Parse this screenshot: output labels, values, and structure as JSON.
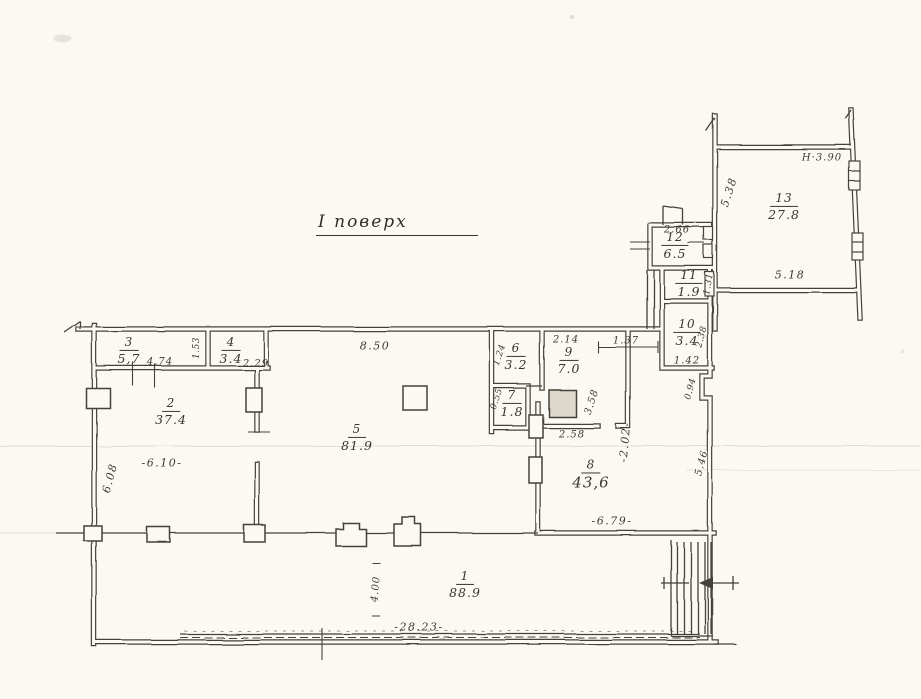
{
  "title": "І поверх",
  "rooms": [
    {
      "number": "1",
      "area": "88.9"
    },
    {
      "number": "2",
      "area": "37.4"
    },
    {
      "number": "3",
      "area": "5,7"
    },
    {
      "number": "4",
      "area": "3.4"
    },
    {
      "number": "5",
      "area": "81.9"
    },
    {
      "number": "6",
      "area": "3.2"
    },
    {
      "number": "7",
      "area": "1.8"
    },
    {
      "number": "8",
      "area": "43,6"
    },
    {
      "number": "9",
      "area": "7.0"
    },
    {
      "number": "10",
      "area": "3.4"
    },
    {
      "number": "11",
      "area": "1.9"
    },
    {
      "number": "12",
      "area": "6.5"
    },
    {
      "number": "13",
      "area": "27.8"
    }
  ],
  "dims": {
    "top_span": "8.50",
    "room2_width": "-6.10-",
    "room2_height": "6.08",
    "room3_width": "4.74",
    "room3_height": "1.53",
    "room4_width": "2.29",
    "room6_width": "1.24",
    "room7_width": "0.55",
    "room9_width": "2.14",
    "room9_height": "3.58",
    "room9_bottom": "2.58",
    "door_span": "1.37",
    "corridor_width": "-2.02-",
    "room8_bottom": "-6.79-",
    "corridor_height": "5.46",
    "wall_jog": "0.94",
    "room10_height": "2.38",
    "room10_bottom": "1.42",
    "room11_height": "1.31",
    "room12_top": "2.66",
    "room13_left": "5.38",
    "room13_bottom": "5.18",
    "ceiling_height": "Н·3.90",
    "room1_depth": "4.00",
    "total_width": "-28.23-"
  },
  "colors": {
    "ink": "#45413a",
    "paper": "#fbf9f3"
  }
}
